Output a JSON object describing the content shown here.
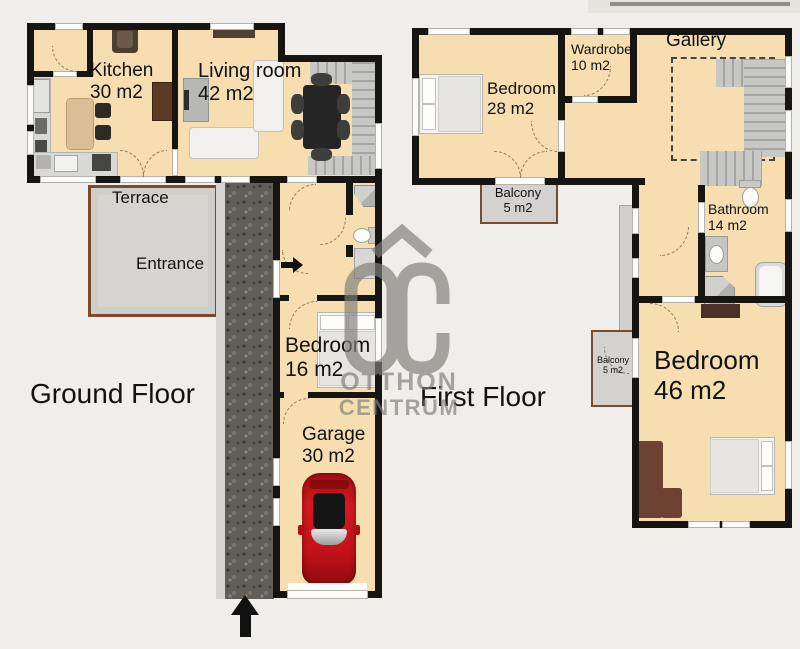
{
  "ground_floor": {
    "title": "Ground Floor",
    "rooms": {
      "kitchen": {
        "name": "Kitchen",
        "area": "30 m2"
      },
      "living_room": {
        "name": "Living room",
        "area": "42 m2"
      },
      "terrace": {
        "name": "Terrace"
      },
      "entrance": {
        "name": "Entrance"
      },
      "bedroom": {
        "name": "Bedroom",
        "area": "16 m2"
      },
      "garage": {
        "name": "Garage",
        "area": "30 m2"
      }
    }
  },
  "first_floor": {
    "title": "First Floor",
    "rooms": {
      "bedroom_28": {
        "name": "Bedroom",
        "area": "28 m2"
      },
      "wardrobe": {
        "name": "Wardrobe",
        "area": "10 m2"
      },
      "gallery": {
        "name": "Gallery"
      },
      "balcony_upper": {
        "name": "Balcony",
        "area": "5 m2"
      },
      "bathroom": {
        "name": "Bathroom",
        "area": "14 m2"
      },
      "balcony_lower": {
        "name": "Balcony",
        "area": "5 m2"
      },
      "bedroom_46": {
        "name": "Bedroom",
        "area": "46 m2"
      }
    }
  },
  "watermark": {
    "monogram": "OC",
    "line1": "OTTHON",
    "line2": "CENTRUM"
  },
  "colors": {
    "background": "#f0eeea",
    "room_fill": "#f6deb0",
    "wall": "#171512",
    "terrace_fill": "#d5d4d1",
    "terrace_border": "#7b4a2b",
    "driveway": "#615d58",
    "stairs": "#c8c8c6",
    "car": "#c6121a",
    "watermark": "#827f7a",
    "label_text": "#121212"
  }
}
